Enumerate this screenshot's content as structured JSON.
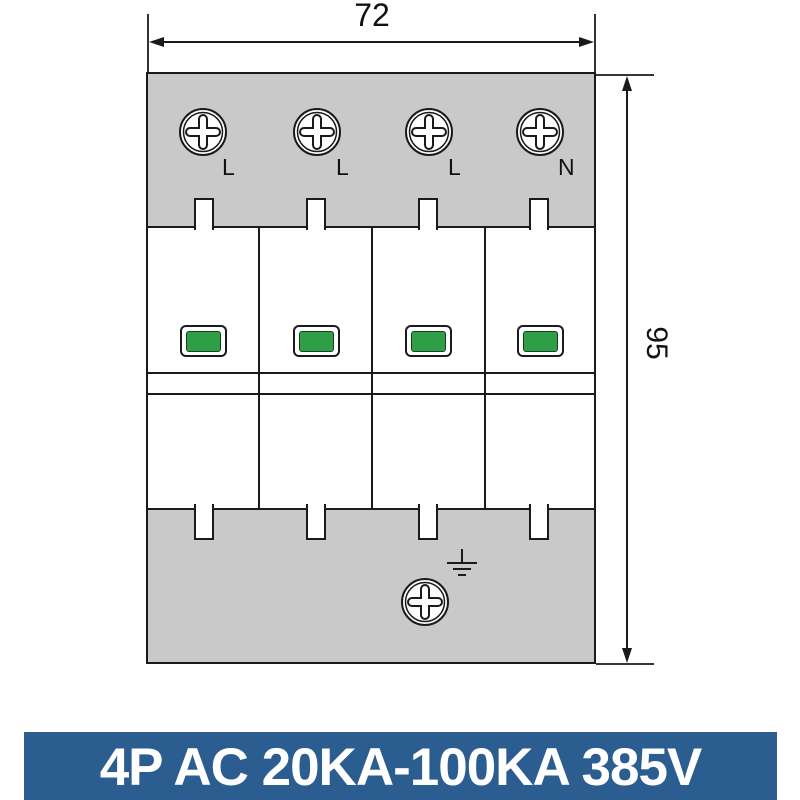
{
  "title": "4P surge protective device dimensional drawing",
  "dimensions": {
    "width": "72",
    "height": "95"
  },
  "device": {
    "module_count": 4,
    "terminal_labels": [
      "L",
      "L",
      "L",
      "N"
    ],
    "indicator_status": "green",
    "icons": {
      "terminal_screw": "phillips-screw",
      "ground_screw": "phillips-screw",
      "ground": "earth-ground-symbol"
    }
  },
  "banner": {
    "text": "4P AC 20KA-100KA 385V"
  },
  "colors": {
    "housing-gray": "#c9c9c9",
    "indicator-green": "#2f9e47",
    "banner-blue": "#2b5d90",
    "line-dark": "#1a1a1a",
    "text-white": "#ffffff"
  }
}
